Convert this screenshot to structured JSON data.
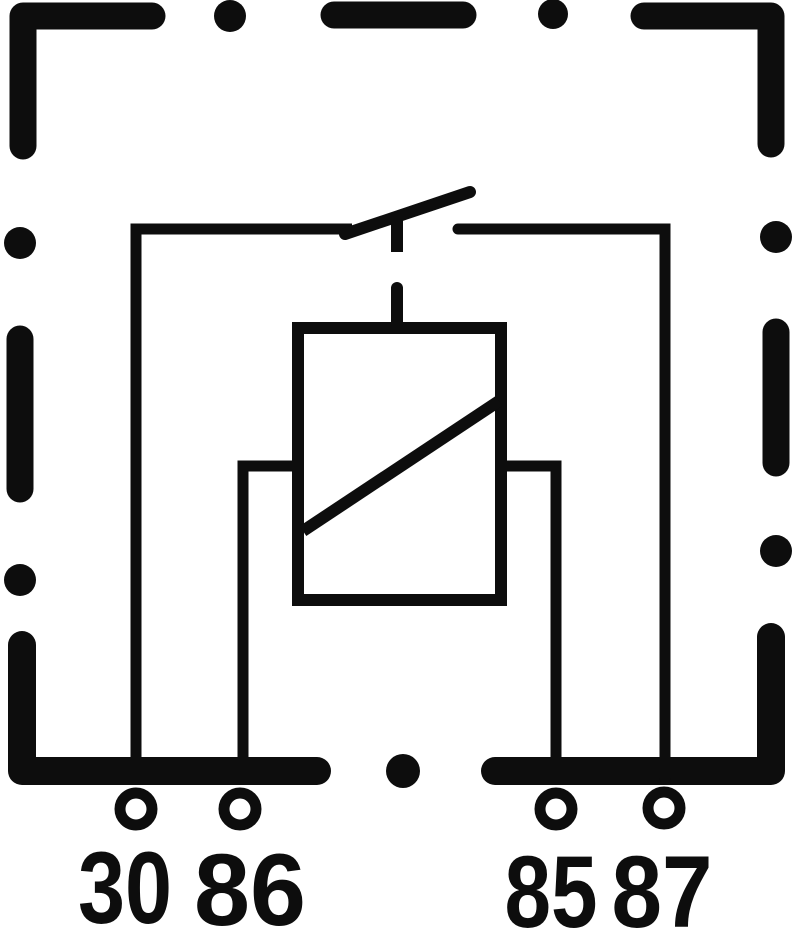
{
  "figure": {
    "kind": "relay-internal-wiring-schematic",
    "colors": {
      "ink": "#0d0d0d",
      "background": "#ffffff"
    },
    "housing": {
      "style": "dashed-rectangular-outline"
    },
    "components": {
      "switch_contact": "normally-open-contact",
      "coil": "rectangle-with-diagonal-winding-symbol",
      "actuator_link": "dashed-vertical-link"
    },
    "terminals": [
      {
        "label": "30"
      },
      {
        "label": "86"
      },
      {
        "label": "85"
      },
      {
        "label": "87"
      }
    ]
  }
}
